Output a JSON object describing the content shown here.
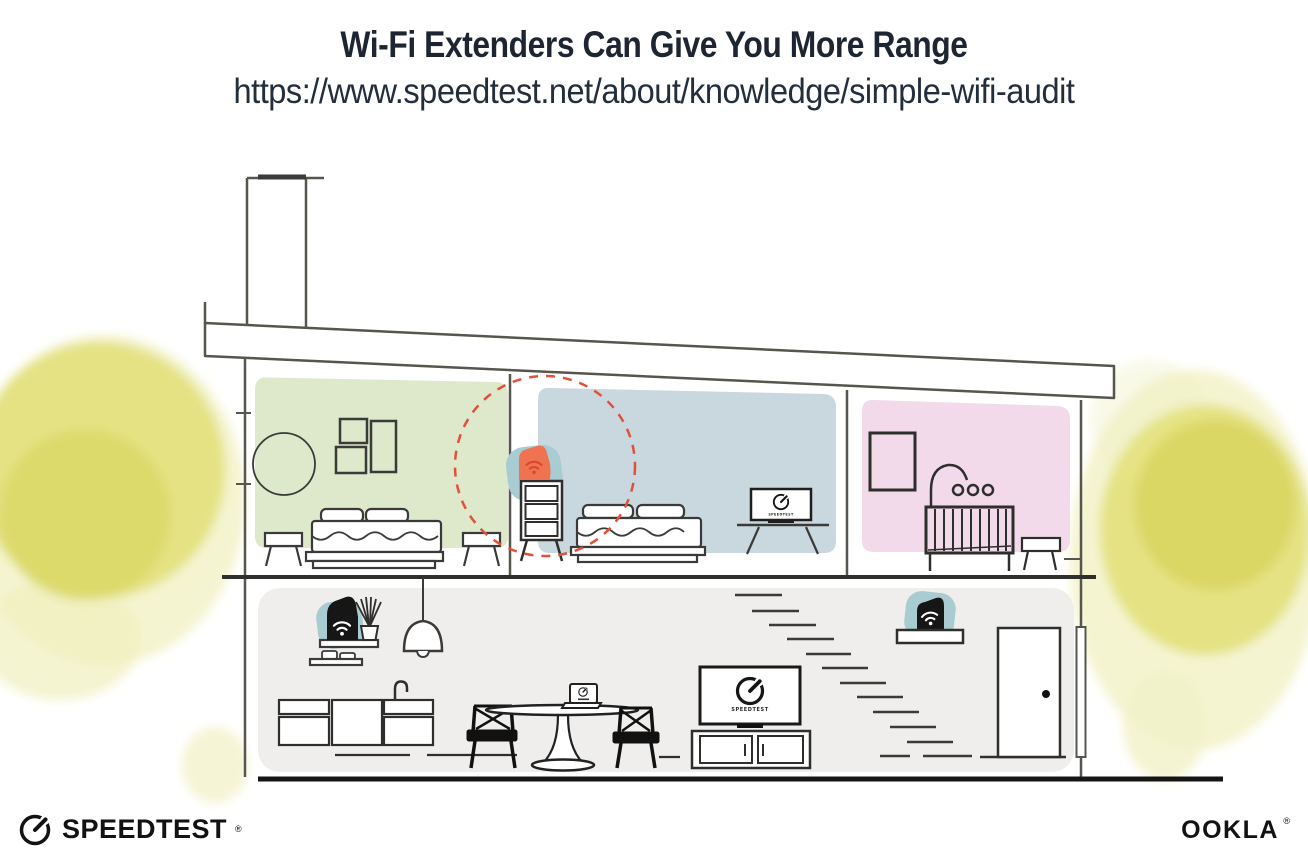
{
  "header": {
    "title": "Wi-Fi Extenders Can Give You More Range",
    "url": "https://www.speedtest.net/about/knowledge/simple-wifi-audit"
  },
  "illustration": {
    "tv_screen_label": "SPEEDTEST",
    "icons": {
      "wifi": "wifi-icon",
      "gauge": "speedtest-gauge-icon"
    },
    "colors": {
      "title_text": "#1c2531",
      "outline": "#56564e",
      "furniture": "#3a3a38",
      "green_room": "#dce7c8",
      "blue_room": "#c5d6dc",
      "pink_room": "#f1d8e9",
      "lower_room": "#efeeec",
      "teal_accent": "#a9cbd2",
      "extender_orange": "#ef7350",
      "wifi_range_red": "#e2503a",
      "watercolor_yellow": "#e4e17e",
      "device_black": "#161616"
    }
  },
  "branding": {
    "speedtest": "SPEEDTEST",
    "speedtest_reg": "®",
    "ookla": "OOKLA",
    "ookla_reg": "®"
  }
}
